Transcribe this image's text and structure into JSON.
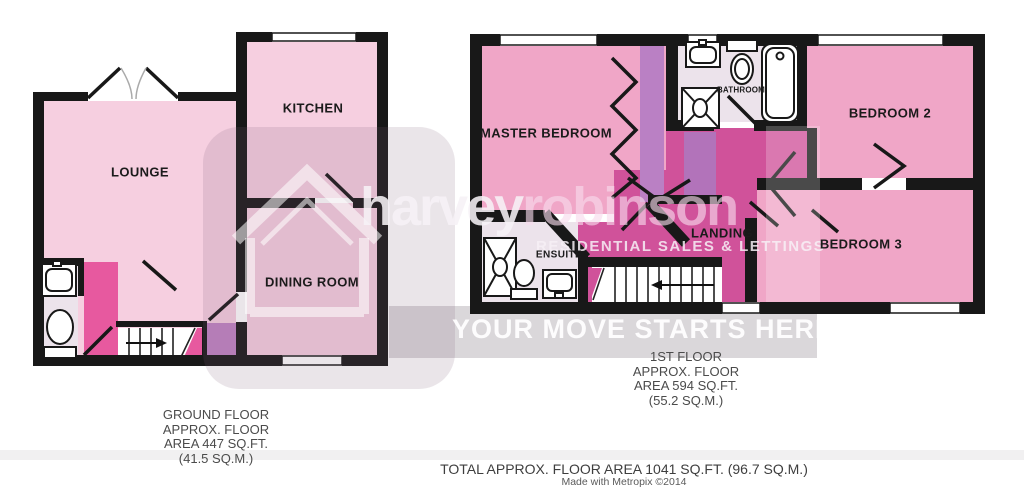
{
  "brand": {
    "name_first": "harvey",
    "name_second": "robinson",
    "tagline": "RESIDENTIAL SALES & LETTINGS",
    "slogan": "YOUR MOVE STARTS HERE"
  },
  "rooms": {
    "lounge": "LOUNGE",
    "kitchen": "KITCHEN",
    "dining": "DINING ROOM",
    "master": "MASTER BEDROOM",
    "bathroom": "BATHROOM",
    "bedroom2": "BEDROOM 2",
    "bedroom3": "BEDROOM 3",
    "landing": "LANDING",
    "ensuite": "ENSUITE"
  },
  "ground_caption": {
    "l1": "GROUND FLOOR",
    "l2": "APPROX. FLOOR",
    "l3": "AREA 447 SQ.FT.",
    "l4": "(41.5 SQ.M.)"
  },
  "first_caption": {
    "l1": "1ST FLOOR",
    "l2": "APPROX. FLOOR",
    "l3": "AREA 594 SQ.FT.",
    "l4": "(55.2 SQ.M.)"
  },
  "footer": {
    "total": "TOTAL APPROX. FLOOR AREA 1041 SQ.FT. (96.7 SQ.M.)",
    "credit": "Made with Metropix ©2014"
  },
  "colors": {
    "wall": "#181818",
    "room_pink_light": "#f6cfe0",
    "bedroom_pink": "#f0a6c7",
    "landing_magenta": "#d0529a",
    "hallway_pink": "#e7599f",
    "stairs_purple": "#c084c4",
    "wardrobe_mauve": "#ba80c4",
    "lilac": "#b273ba",
    "wet_room_floor": "#ece3eb"
  }
}
